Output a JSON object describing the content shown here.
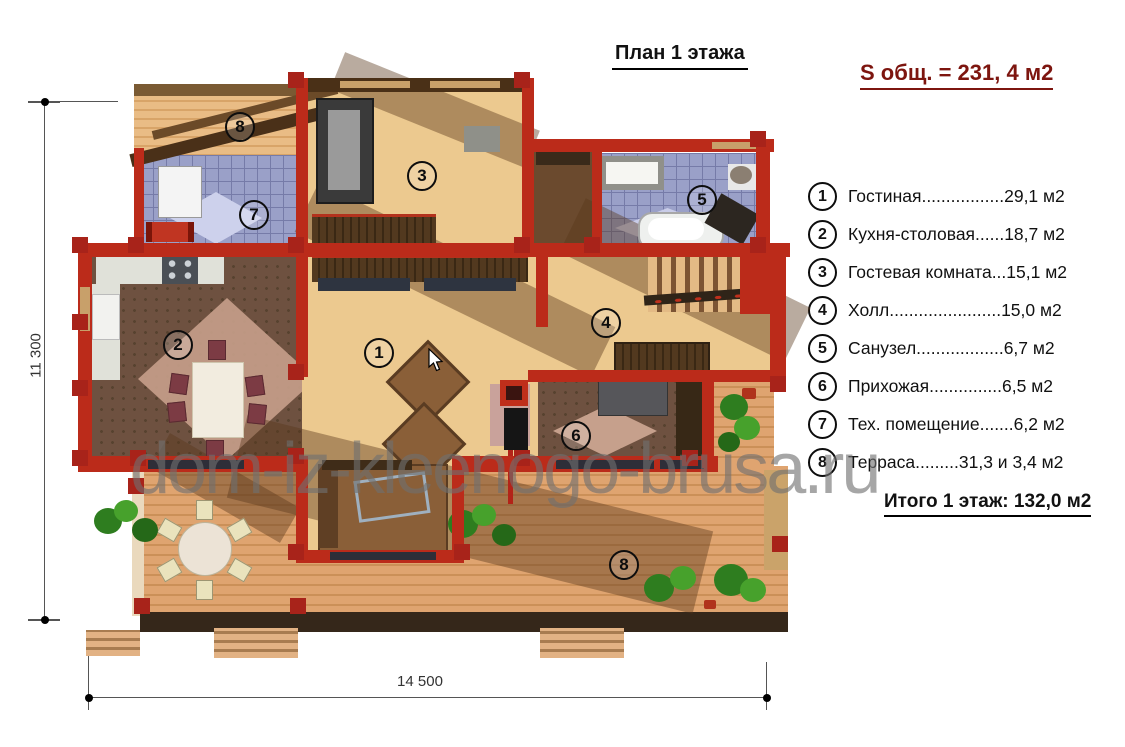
{
  "title": "План 1 этажа",
  "total_area_label": "S общ. = 231, 4 м2",
  "legend": {
    "items": [
      {
        "num": "1",
        "text": "Гостиная.................29,1 м2"
      },
      {
        "num": "2",
        "text": "Кухня-столовая......18,7 м2"
      },
      {
        "num": "3",
        "text": "Гостевая комната...15,1 м2"
      },
      {
        "num": "4",
        "text": "Холл.......................15,0 м2"
      },
      {
        "num": "5",
        "text": "Санузел..................6,7 м2"
      },
      {
        "num": "6",
        "text": "Прихожая...............6,5 м2"
      },
      {
        "num": "7",
        "text": "Тех. помещение.......6,2 м2"
      },
      {
        "num": "8",
        "text": "Терраса.........31,3 и 3,4 м2"
      }
    ]
  },
  "floor_total": "Итого 1 этаж:  132,0 м2",
  "dimensions": {
    "height": "11 300",
    "width": "14 500"
  },
  "watermark": "dom-iz-kleenogo-brusa.ru",
  "plan_badges": {
    "living": "1",
    "kitchen": "2",
    "guest": "3",
    "hall": "4",
    "bath": "5",
    "entry": "6",
    "tech": "7",
    "terrace_top": "8",
    "terrace_bottom": "8"
  },
  "colors": {
    "wall_red": "#bb2b1a",
    "area_text_red": "#7d150f",
    "watermark_gray": "#707070"
  }
}
